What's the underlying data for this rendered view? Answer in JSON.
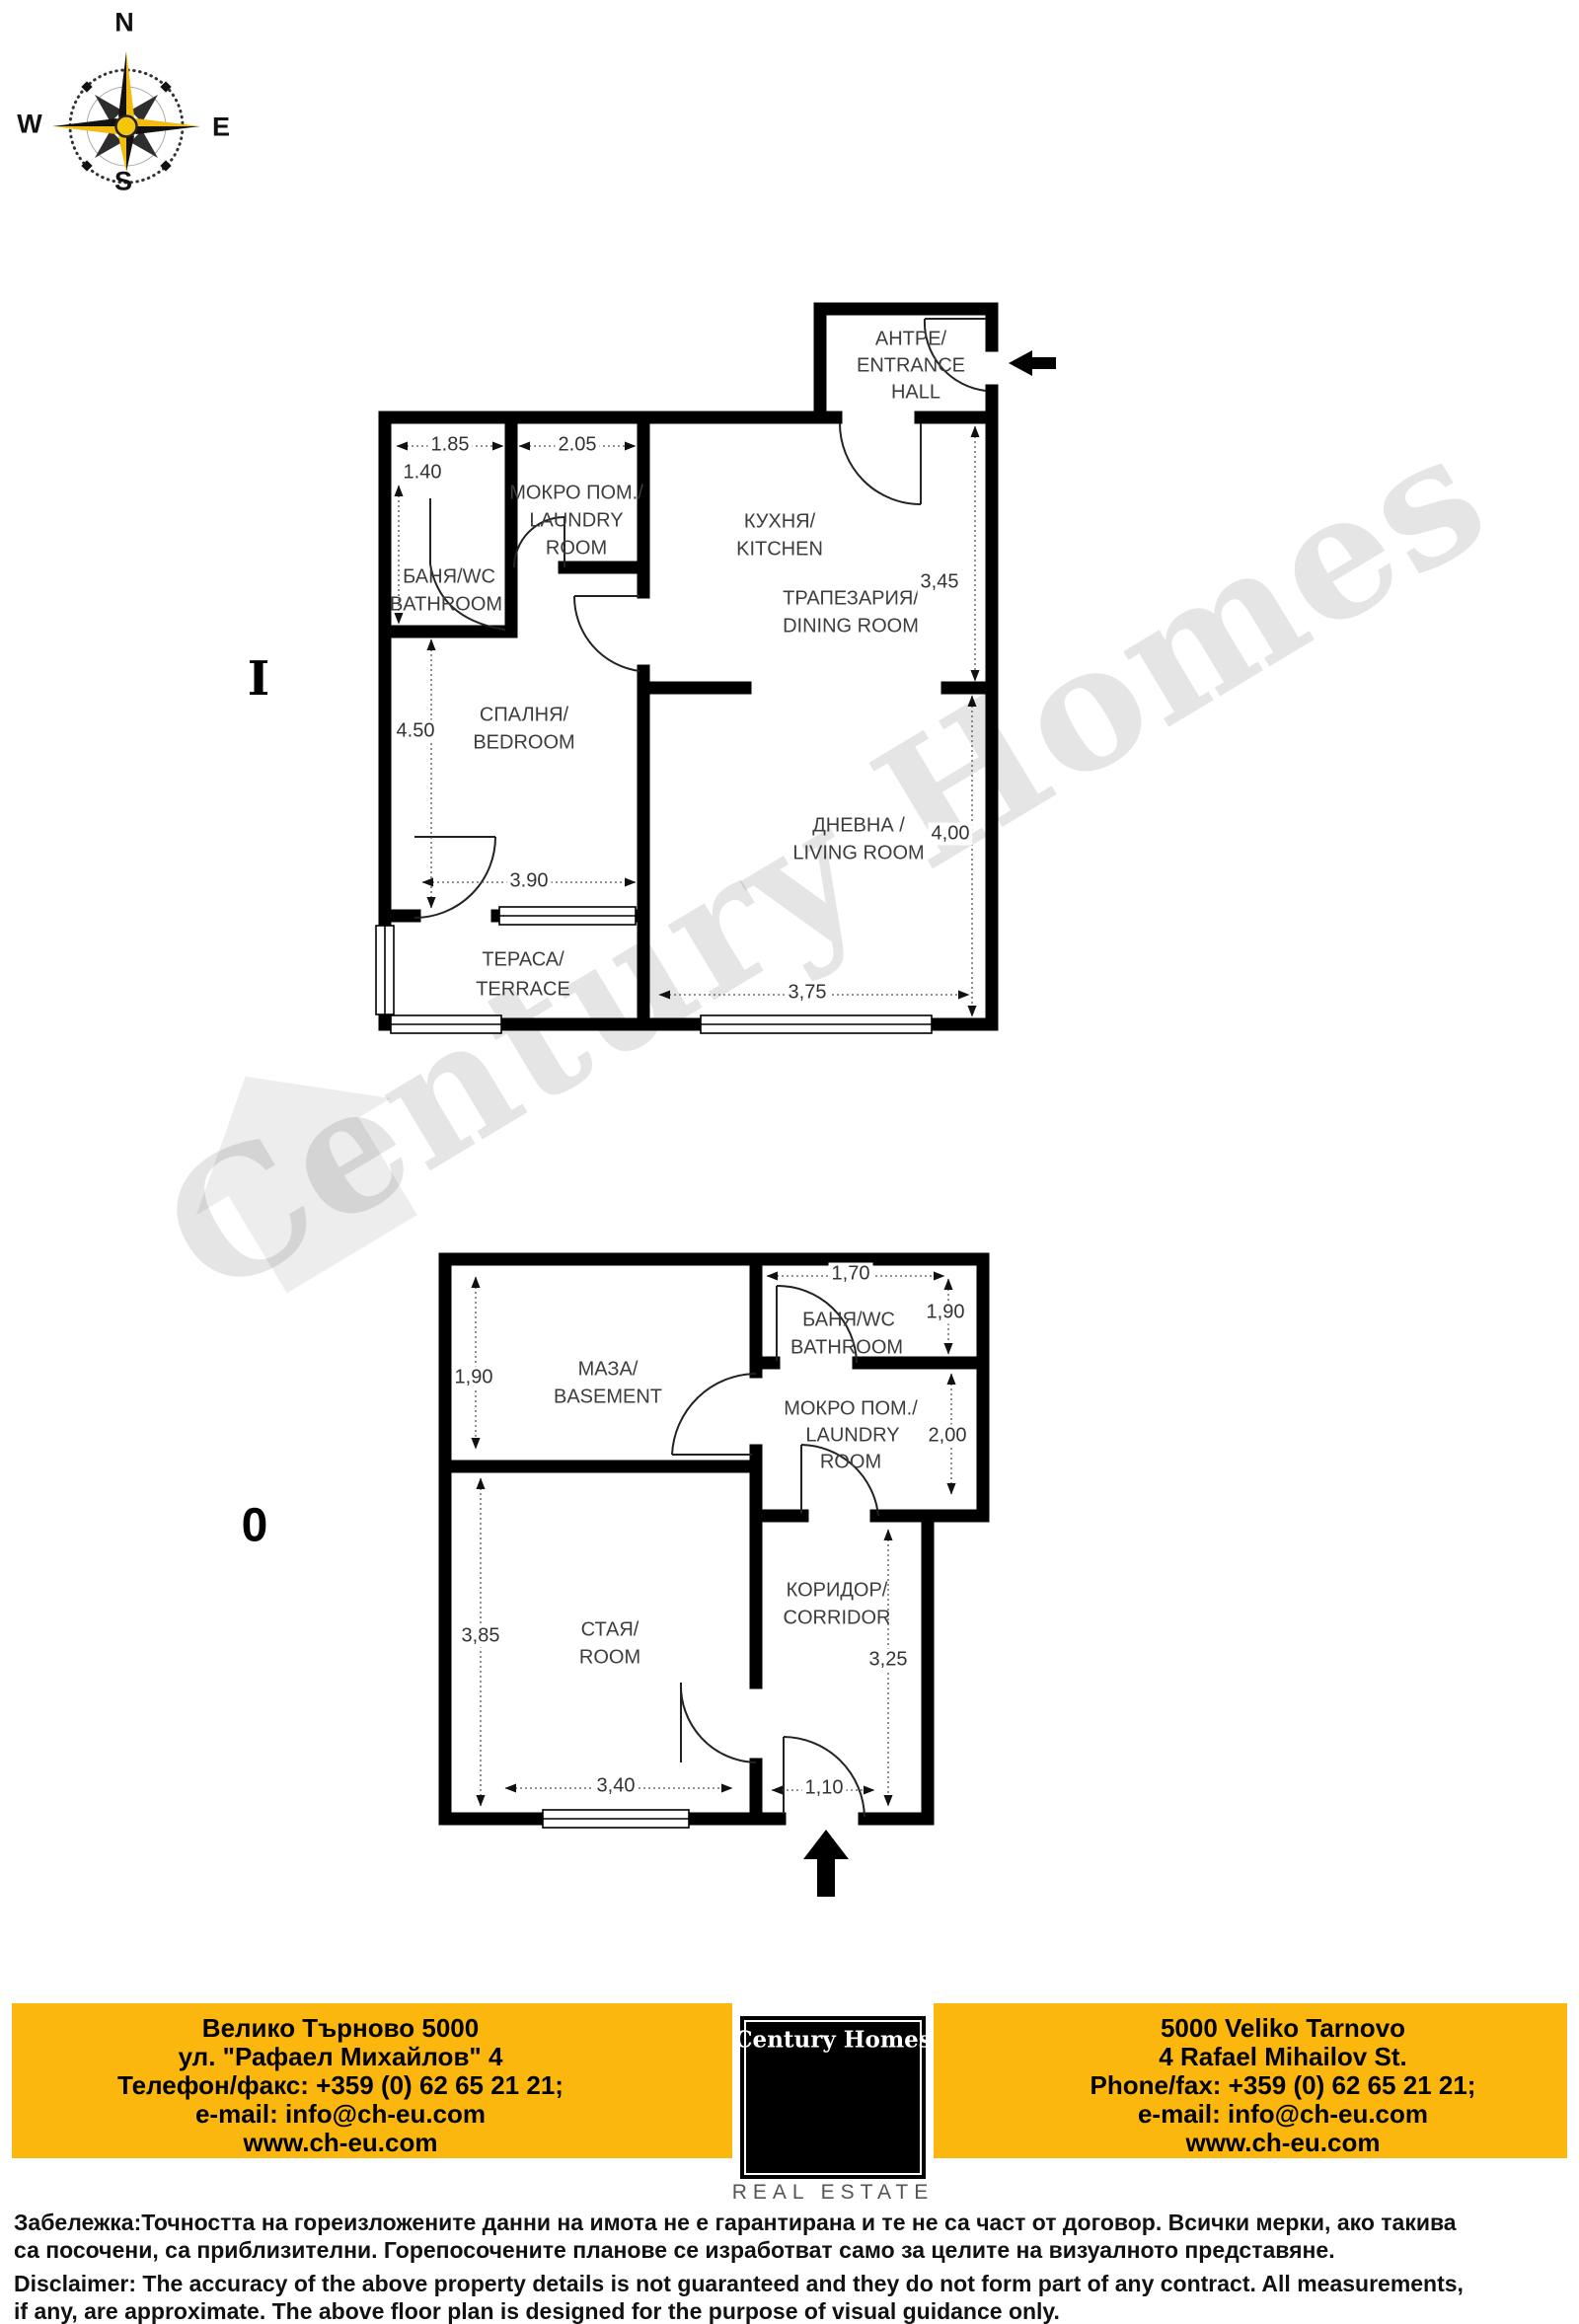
{
  "compass": {
    "n": "N",
    "e": "E",
    "s": "S",
    "w": "W"
  },
  "watermark": {
    "text": "Century Homes"
  },
  "plan1": {
    "floor_label": "I",
    "rooms": {
      "entrance": {
        "l1": "АНТРЕ/",
        "l2": "ENTRANCE",
        "l3": "HALL"
      },
      "kitchen": {
        "l1": "КУХНЯ/",
        "l2": "KITCHEN"
      },
      "laundry": {
        "l1": "МОКРО ПОМ./",
        "l2": "LAUNDRY",
        "l3": "ROOM"
      },
      "bathroom": {
        "l1": "БАНЯ/WC",
        "l2": "BATHROOM"
      },
      "dining": {
        "l1": "ТРАПЕЗАРИЯ/",
        "l2": "DINING ROOM"
      },
      "bedroom": {
        "l1": "СПАЛНЯ/",
        "l2": "BEDROOM"
      },
      "living": {
        "l1": "ДНЕВНА /",
        "l2": "LIVING ROOM"
      },
      "terrace": {
        "l1": "ТЕРАСА/",
        "l2": "TERRACE"
      }
    },
    "dims": {
      "bathroom_width": "1.85",
      "laundry_width": "2.05",
      "bathroom_height": "1.40",
      "kitchen_height": "3,45",
      "bedroom_height": "4.50",
      "bedroom_width": "3.90",
      "living_height": "4,00",
      "living_width": "3,75"
    }
  },
  "plan0": {
    "floor_label": "0",
    "rooms": {
      "basement": {
        "l1": "МАЗА/",
        "l2": "BASEMENT"
      },
      "bathroom": {
        "l1": "БАНЯ/WC",
        "l2": "BATHROOM"
      },
      "laundry": {
        "l1": "МОКРО ПОМ./",
        "l2": "LAUNDRY",
        "l3": "ROOM"
      },
      "corridor": {
        "l1": "КОРИДОР/",
        "l2": "CORRIDOR"
      },
      "room": {
        "l1": "СТАЯ/",
        "l2": "ROOM"
      }
    },
    "dims": {
      "basement_height": "1,90",
      "bathroom_width": "1,70",
      "bathroom_height": "1,90",
      "laundry_height": "2,00",
      "room_height": "3,85",
      "room_width": "3,40",
      "corridor_height": "3,25",
      "entry_width": "1,10"
    }
  },
  "footer": {
    "left": {
      "l1": "Велико Търново 5000",
      "l2": "ул. \"Рафаел Михайлов\" 4",
      "l3": "Телефон/факс: +359 (0) 62 65 21 21;",
      "l4": "e-mail: info@ch-eu.com",
      "l5": "www.ch-eu.com"
    },
    "logo": {
      "title": "Century Homes",
      "subtitle": "REAL ESTATE"
    },
    "right": {
      "l1": "5000 Veliko Tarnovo",
      "l2": "4 Rafael Mihailov St.",
      "l3": "Phone/fax: +359 (0) 62 65 21 21;",
      "l4": "e-mail: info@ch-eu.com",
      "l5": "www.ch-eu.com"
    },
    "colors": {
      "band": "#FBB70D",
      "logo_bg": "#000000",
      "logo_yellow": "#FCBE11"
    }
  },
  "disclaimer": {
    "bg1": "Забележка:Точността на гореизложените данни на имота не е гарантирана и те не са част от договор. Всички мерки, ако такива",
    "bg2": "са посочени, са приблизителни. Горепосочените планове се изработват само за целите на визуалното представяне.",
    "en1": "Disclaimer: The accuracy of the above property details is not guaranteed and they do not form part of any contract. All measurements,",
    "en2": "if any, are approximate. The above floor plan is designed for the purpose of visual guidance only."
  }
}
